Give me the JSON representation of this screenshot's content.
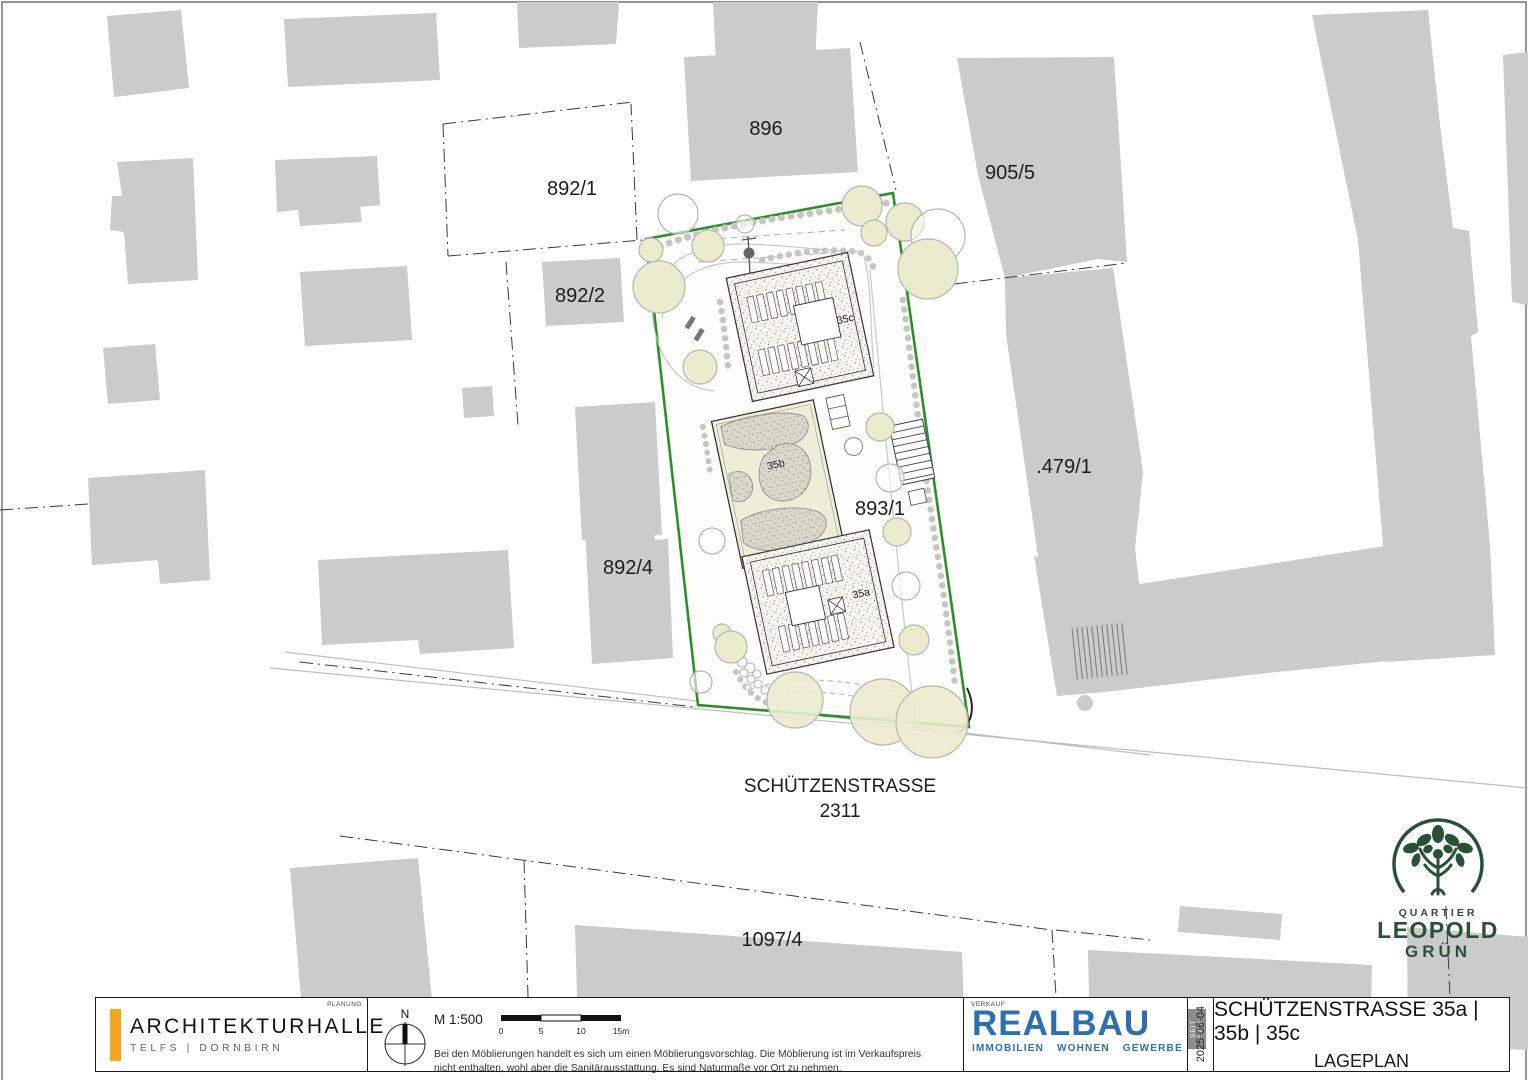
{
  "plan": {
    "parcels": {
      "p892_1": "892/1",
      "p892_2": "892/2",
      "p896": "896",
      "p905_5": "905/5",
      "p479_1": ".479/1",
      "p893_1": "893/1",
      "p892_4": "892/4",
      "p1097_4": "1097/4"
    },
    "street": {
      "name": "SCHÜTZENSTRASSE",
      "parcel": "2311"
    },
    "buildings": {
      "a": "35a",
      "b": "35b",
      "c": "35c"
    }
  },
  "logo_quartier": {
    "line1": "QUARTIER",
    "line2": "LEOPOLD",
    "line3": "GRÜN",
    "color": "#2a5137"
  },
  "titleblock": {
    "planning_label": "PLANUNG",
    "company": "ARCHITEKTURHALLE",
    "company_sub": "TELFS  |  DORNBIRN",
    "north_label": "N",
    "scale": "M 1:500",
    "scale_ticks": [
      "0",
      "5",
      "10",
      "15m"
    ],
    "disclaimer_line1": "Bei den Möblierungen handelt es sich um einen Möblierungsvorschlag. Die Möblierung ist im Verkaufspreis",
    "disclaimer_line2": "nicht enthalten, wohl aber die Sanitärausstattung. Es sind Naturmaße vor Ort zu nehmen.",
    "sales_label": "VERKAUF",
    "realbau": "REALBAU",
    "realbau_sub": [
      "IMMOBILIEN",
      "WOHNEN",
      "GEWERBE"
    ],
    "realbau_seit": "SEIT 1971",
    "date": "2025-06-04",
    "title_line1": "SCHÜTZENSTRASSE 35a | 35b | 35c",
    "title_line2": "LAGEPLAN"
  },
  "colors": {
    "site_boundary_green": "#2c8f2c",
    "building_gray": "#cccbcb",
    "tree_fill": "#ecebce",
    "realbau_blue": "#2e6fae",
    "accent_orange": "#f1a71f",
    "logo_green": "#2a5137"
  }
}
